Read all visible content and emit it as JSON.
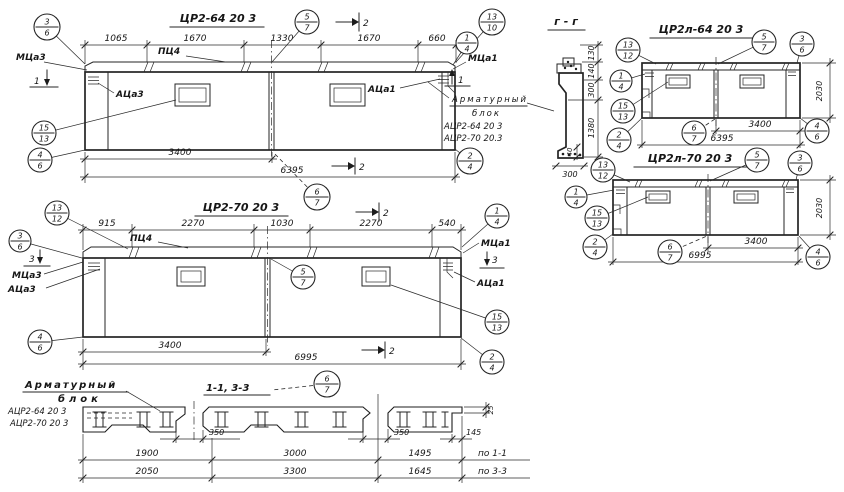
{
  "drawing": {
    "ink": "#242424",
    "bg": "#ffffff",
    "view1": {
      "title": "ЦР2-64 20 3",
      "top_dims": [
        "1065",
        "1670",
        "1330",
        "1670",
        "660"
      ],
      "cap_label": "ПЦ4",
      "left_corner_label": "МЦа3",
      "left_panel_label": "АЦа3",
      "right_corner_label": "МЦа1",
      "right_panel_label": "АЦа1",
      "sec1_left": "1",
      "sec1_right": "1",
      "sec2_top": "2",
      "sec2_bottom": "2",
      "dim_panel": "3400",
      "dim_total": "6395"
    },
    "note_right": {
      "line1": "Арматурный",
      "line2": "блок",
      "item1": "АЦР2-64 20 3",
      "item2": "АЦР2-70 20.3"
    },
    "section_gg": {
      "title": "г - г",
      "dim_130": "130",
      "dim_140": "140",
      "dim_300": "300",
      "dim_1380": "1380",
      "dim_40": "40",
      "dim_base": "300"
    },
    "view2": {
      "title": "ЦР2л-64 20 3",
      "dim_panel": "3400",
      "dim_total": "6395",
      "dim_height": "2030"
    },
    "view3": {
      "title": "ЦР2л-70 20 3",
      "dim_panel": "3400",
      "dim_total": "6995",
      "dim_height": "2030"
    },
    "view4": {
      "title": "ЦР2-70 20 3",
      "top_dims": [
        "915",
        "2270",
        "1030",
        "2270",
        "540"
      ],
      "cap_label": "ПЦ4",
      "left_corner_label": "МЦа3",
      "left_panel_label": "АЦа3",
      "right_corner_label": "МЦа1",
      "right_panel_label": "АЦа1",
      "sec3_left": "3",
      "sec3_right": "3",
      "sec2_top": "2",
      "sec2_bottom": "2",
      "dim_panel": "3400",
      "dim_total": "6995"
    },
    "note_left": {
      "line1": "Арматурный",
      "line2": "блок",
      "item1": "АЦР2-64 20 3",
      "item2": "АЦР2-70 20 3"
    },
    "section_13": {
      "title": "1-1, 3-3",
      "dim_350_left": "350",
      "dim_350_right": "350",
      "dim_145": "145",
      "dim_25": "25",
      "row1": [
        "1900",
        "3000",
        "1495",
        "по 1-1"
      ],
      "row2": [
        "2050",
        "3300",
        "1645",
        "по 3-3"
      ]
    },
    "callouts": [
      {
        "x": 47,
        "y": 27,
        "r": 13,
        "top": "3",
        "bottom": "6",
        "lx": 85,
        "ly": 64
      },
      {
        "x": 307,
        "y": 22,
        "r": 12,
        "top": "5",
        "bottom": "7",
        "lx": 272,
        "ly": 62
      },
      {
        "x": 492,
        "y": 22,
        "r": 13,
        "top": "13",
        "bottom": "10",
        "lx": 456,
        "ly": 62
      },
      {
        "x": 467,
        "y": 43,
        "r": 11,
        "top": "1",
        "bottom": "4",
        "lx": 453,
        "ly": 65
      },
      {
        "x": 44,
        "y": 133,
        "r": 12,
        "top": "15",
        "bottom": "13",
        "lx": 176,
        "ly": 100
      },
      {
        "x": 40,
        "y": 160,
        "r": 12,
        "top": "4",
        "bottom": "6",
        "lx": 85,
        "ly": 150
      },
      {
        "x": 470,
        "y": 161,
        "r": 13,
        "top": "2",
        "bottom": "4",
        "lx": 455,
        "ly": 149
      },
      {
        "x": 317,
        "y": 197,
        "r": 13,
        "top": "6",
        "bottom": "7",
        "lx": 273,
        "ly": 152,
        "dash": true
      },
      {
        "x": 628,
        "y": 50,
        "r": 12,
        "top": "13",
        "bottom": "12",
        "lx": 656,
        "ly": 64
      },
      {
        "x": 621,
        "y": 81,
        "r": 11,
        "top": "1",
        "bottom": "4",
        "lx": 645,
        "ly": 74
      },
      {
        "x": 623,
        "y": 111,
        "r": 12,
        "top": "15",
        "bottom": "13",
        "lx": 668,
        "ly": 82
      },
      {
        "x": 619,
        "y": 140,
        "r": 12,
        "top": "2",
        "bottom": "4",
        "lx": 642,
        "ly": 118
      },
      {
        "x": 764,
        "y": 42,
        "r": 12,
        "top": "5",
        "bottom": "7",
        "lx": 718,
        "ly": 64
      },
      {
        "x": 802,
        "y": 44,
        "r": 12,
        "top": "3",
        "bottom": "6",
        "lx": 797,
        "ly": 63
      },
      {
        "x": 817,
        "y": 131,
        "r": 12,
        "top": "4",
        "bottom": "6",
        "lx": 800,
        "ly": 118
      },
      {
        "x": 694,
        "y": 133,
        "r": 12,
        "top": "6",
        "bottom": "7",
        "lx": 715,
        "ly": 119,
        "dash": true
      },
      {
        "x": 603,
        "y": 170,
        "r": 12,
        "top": "13",
        "bottom": "12",
        "lx": 630,
        "ly": 182
      },
      {
        "x": 576,
        "y": 197,
        "r": 11,
        "top": "1",
        "bottom": "4",
        "lx": 614,
        "ly": 190
      },
      {
        "x": 597,
        "y": 218,
        "r": 12,
        "top": "15",
        "bottom": "13",
        "lx": 648,
        "ly": 197
      },
      {
        "x": 595,
        "y": 247,
        "r": 12,
        "top": "2",
        "bottom": "4",
        "lx": 613,
        "ly": 234
      },
      {
        "x": 757,
        "y": 160,
        "r": 12,
        "top": "5",
        "bottom": "7",
        "lx": 710,
        "ly": 181
      },
      {
        "x": 800,
        "y": 163,
        "r": 12,
        "top": "3",
        "bottom": "6",
        "lx": 796,
        "ly": 180
      },
      {
        "x": 818,
        "y": 257,
        "r": 12,
        "top": "4",
        "bottom": "6",
        "lx": 799,
        "ly": 236
      },
      {
        "x": 670,
        "y": 252,
        "r": 12,
        "top": "6",
        "bottom": "7",
        "lx": 707,
        "ly": 236,
        "dash": true
      },
      {
        "x": 57,
        "y": 213,
        "r": 12,
        "top": "13",
        "bottom": "12",
        "lx": 128,
        "ly": 249
      },
      {
        "x": 20,
        "y": 241,
        "r": 11,
        "top": "3",
        "bottom": "6",
        "lx": 82,
        "ly": 258
      },
      {
        "x": 497,
        "y": 216,
        "r": 12,
        "top": "1",
        "bottom": "4",
        "lx": 462,
        "ly": 247
      },
      {
        "x": 303,
        "y": 277,
        "r": 12,
        "top": "5",
        "bottom": "7",
        "lx": 271,
        "ly": 259
      },
      {
        "x": 497,
        "y": 322,
        "r": 12,
        "top": "15",
        "bottom": "13",
        "lx": 391,
        "ly": 285
      },
      {
        "x": 40,
        "y": 342,
        "r": 12,
        "top": "4",
        "bottom": "6",
        "lx": 83,
        "ly": 337
      },
      {
        "x": 492,
        "y": 362,
        "r": 12,
        "top": "2",
        "bottom": "4",
        "lx": 461,
        "ly": 338
      },
      {
        "x": 327,
        "y": 384,
        "r": 13,
        "top": "6",
        "bottom": "7",
        "lx": 272,
        "ly": 390,
        "dash": true
      }
    ]
  }
}
